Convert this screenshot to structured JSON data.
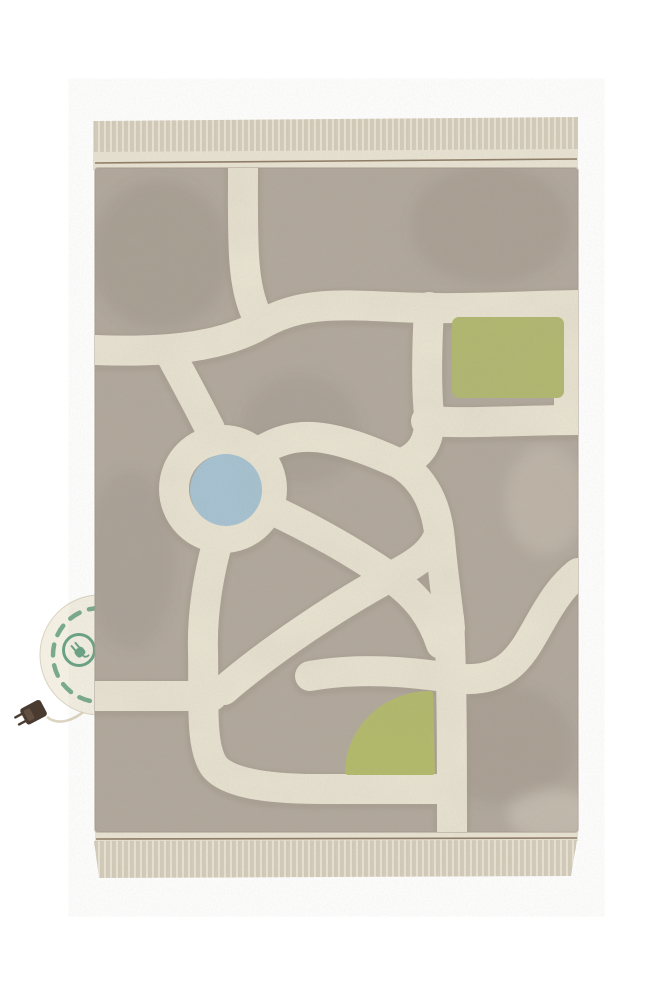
{
  "image": {
    "type": "product-photo",
    "subject": "Washable children's play rug with a tufted city road-map design",
    "pattern": "Cream roads over a taupe pile: a roundabout with a blue pond center, a green park square at the upper right, a green quarter-circle park near the bottom, roads exiting the top, left, right and bottom edges",
    "edges": "Cream tasseled fringe along the top and bottom edges with a thin brown hem line",
    "tag": "Round cream fabric tag tucked under the left edge, green dashed border, green electric-plug emblem, with a cream cord and a dark brown plug charm hanging below"
  },
  "icons": {
    "tag_emblem": "electric-plug-icon"
  },
  "colors": {
    "background": "#ffffff",
    "rug_base": "#b2a99d",
    "rug_edge": "#a69c8e",
    "road": "#ebe5d4",
    "road_edge": "#a1978a",
    "fringe": "#e2dbcb",
    "fringe_strand_dark": "#cfc6b4",
    "fringe_strand_light": "#efe9da",
    "fringe_strand_deep": "#c2b9a7",
    "hem_band": "#e9e3d3",
    "hem_line": "#8f7d67",
    "pond_blue": "#a6c3d4",
    "park_green": "#b1b96d",
    "fan_green": "#b3bb68",
    "tag_fill": "#f2efe2",
    "tag_border": "#d9d1be",
    "tag_dash_green": "#79aa8d",
    "plug_icon_green": "#6aa285",
    "plug_brown": "#4a3b31",
    "plug_brown_light": "#6b594a",
    "cord": "#dcd4c1",
    "shade_dark": "#6e655a",
    "shade_light": "#f3eee0"
  }
}
